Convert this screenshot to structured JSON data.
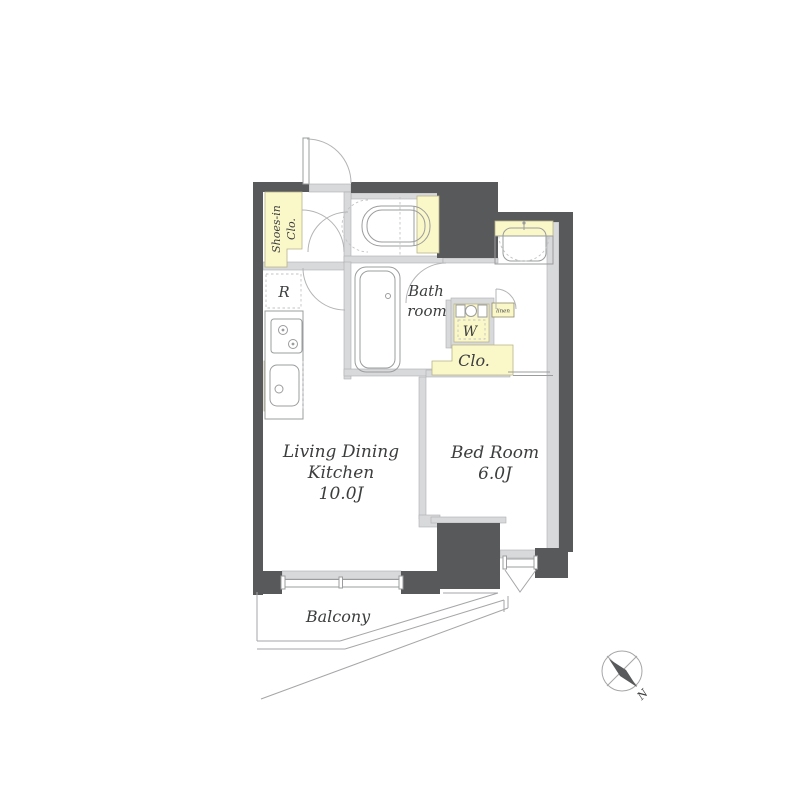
{
  "labels": {
    "shoes_closet_line1": "Shoes-in",
    "shoes_closet_line2": "Clo.",
    "refrigerator": "R",
    "bath_line1": "Bath",
    "bath_line2": "room",
    "washer": "W",
    "linen": "linen",
    "closet": "Clo.",
    "ldk_line1": "Living Dining",
    "ldk_line2": "Kitchen",
    "ldk_size": "10.0J",
    "bedroom_name": "Bed Room",
    "bedroom_size": "6.0J",
    "balcony": "Balcony",
    "compass_north": "N"
  },
  "colors": {
    "wall_dark": "#58595b",
    "wall_light": "#d8d9da",
    "highlight_yellow": "#faf7c9",
    "line_gray": "#9b9c9e",
    "text": "#3c3d3e"
  }
}
